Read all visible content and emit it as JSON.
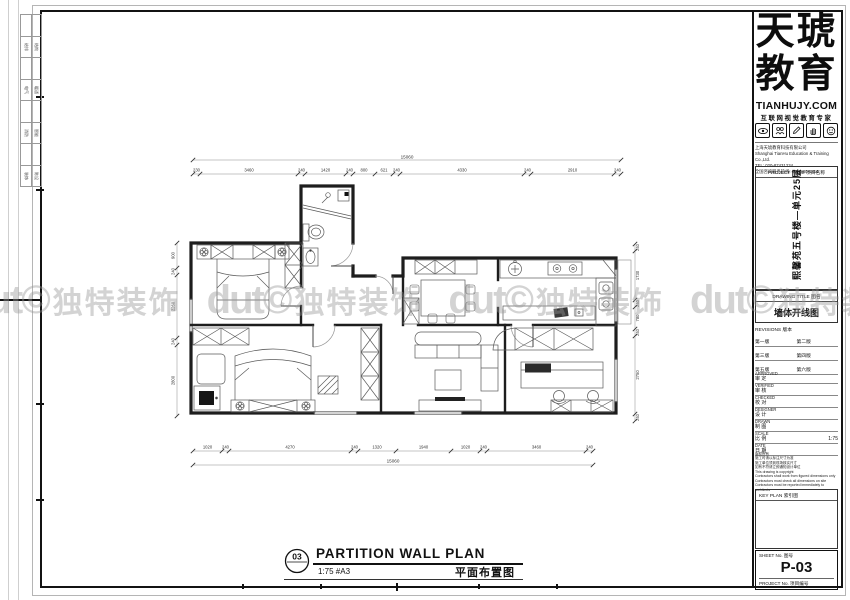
{
  "margin_strip": {
    "rows": [
      [
        "",
        ""
      ],
      [
        "给排",
        "结构"
      ],
      [
        "",
        ""
      ],
      [
        "电气",
        "暖通"
      ],
      [
        "",
        ""
      ],
      [
        "消防",
        "智能"
      ],
      [
        "",
        ""
      ],
      [
        "装饰",
        "陈设"
      ]
    ]
  },
  "watermark": {
    "logo": "dut©",
    "text": "独特装饰",
    "color": "#9a9a9a"
  },
  "logo_block": {
    "brand1": "天琥",
    "brand2": "教育",
    "website": "TIANHUJY.COM",
    "slogan": "互联网视觉教育专家",
    "icons": [
      "eye-icon",
      "people-icon",
      "pencil-icon",
      "hand-icon",
      "smiley-icon"
    ],
    "company": [
      "上海天琥教育科技有限公司",
      "Shanghai TianHu Education & Training Co.,Ltd.",
      "TEL: 020-87431234",
      "全国咨询服务热线: 400-880-1316"
    ]
  },
  "title_block": {
    "project_title_label": "PROJECT TITLE 项目名称",
    "project_title": "熙馨苑五号楼—单元25层",
    "drawing_title_label": "DRAWING TITLE 图名",
    "drawing_title": "墙体开线图",
    "revisions_label": "REVISIONS 版本",
    "revisions": [
      [
        "第一版",
        "第二版"
      ],
      [
        "第三版",
        "第四版"
      ],
      [
        "第五版",
        "第六版"
      ]
    ],
    "staff": [
      {
        "en": "APPROVED",
        "cn": "审 定",
        "value": ""
      },
      {
        "en": "VERIFIED",
        "cn": "审 核",
        "value": ""
      },
      {
        "en": "CHECKED",
        "cn": "校 对",
        "value": ""
      },
      {
        "en": "DESIGNER",
        "cn": "设 计",
        "value": ""
      },
      {
        "en": "DRAWN",
        "cn": "制 图",
        "value": ""
      },
      {
        "en": "SCALE",
        "cn": "比 例",
        "value": "1:75"
      },
      {
        "en": "DATE",
        "cn": "日 期",
        "value": ""
      }
    ],
    "notes": [
      "版权所有",
      "施工时请以标注尺寸为准",
      "施工单位须到现场核实尺寸",
      "如有不符请立即通知设计单位",
      "This drawing is copyright",
      "Contractors shall work from figured dimensions only",
      "Contractors must check all dimensions on site",
      "Contractors must be reported immediately to architects"
    ],
    "key_plan_label": "KEY PLAN 索引图",
    "sheet_no_label": "SHEET No. 图号",
    "sheet_no": "P-03",
    "project_no_label": "PROJECT No. 项目编号"
  },
  "drawing_caption": {
    "number": "03",
    "title": "PARTITION WALL PLAN",
    "scale": "1:75 #A3",
    "title_cn": "平面布置图"
  },
  "plan": {
    "dims_top_total": "15060",
    "dims_top": [
      "230",
      "3460",
      "240",
      "1420",
      "240",
      "800",
      "621",
      "240",
      "4330",
      "240",
      "2910",
      "240"
    ],
    "dims_bottom_total": "15060",
    "dims_bottom": [
      "1020",
      "240",
      "4270",
      "240",
      "1320",
      "1940",
      "1020",
      "240",
      "3460",
      "240"
    ],
    "dims_left": [
      "900",
      "240",
      "2260",
      "240",
      "2800"
    ],
    "dims_right": [
      "240",
      "1730",
      "240",
      "780",
      "240",
      "2750",
      "240"
    ]
  }
}
